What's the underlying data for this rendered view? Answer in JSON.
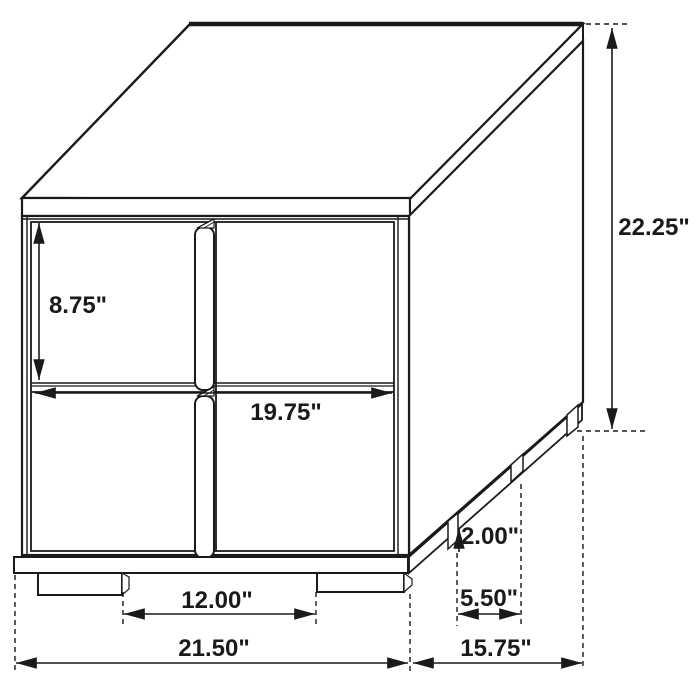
{
  "dims": {
    "height": "22.25\"",
    "upper_drawer_height": "8.75\"",
    "drawer_width": "19.75\"",
    "foot_height": "2.00\"",
    "side_foot_spacing": "5.50\"",
    "front_foot_spacing": "12.00\"",
    "overall_width": "21.50\"",
    "overall_depth": "15.75\""
  },
  "colors": {
    "line": "#1a1a1a",
    "background": "#ffffff"
  }
}
